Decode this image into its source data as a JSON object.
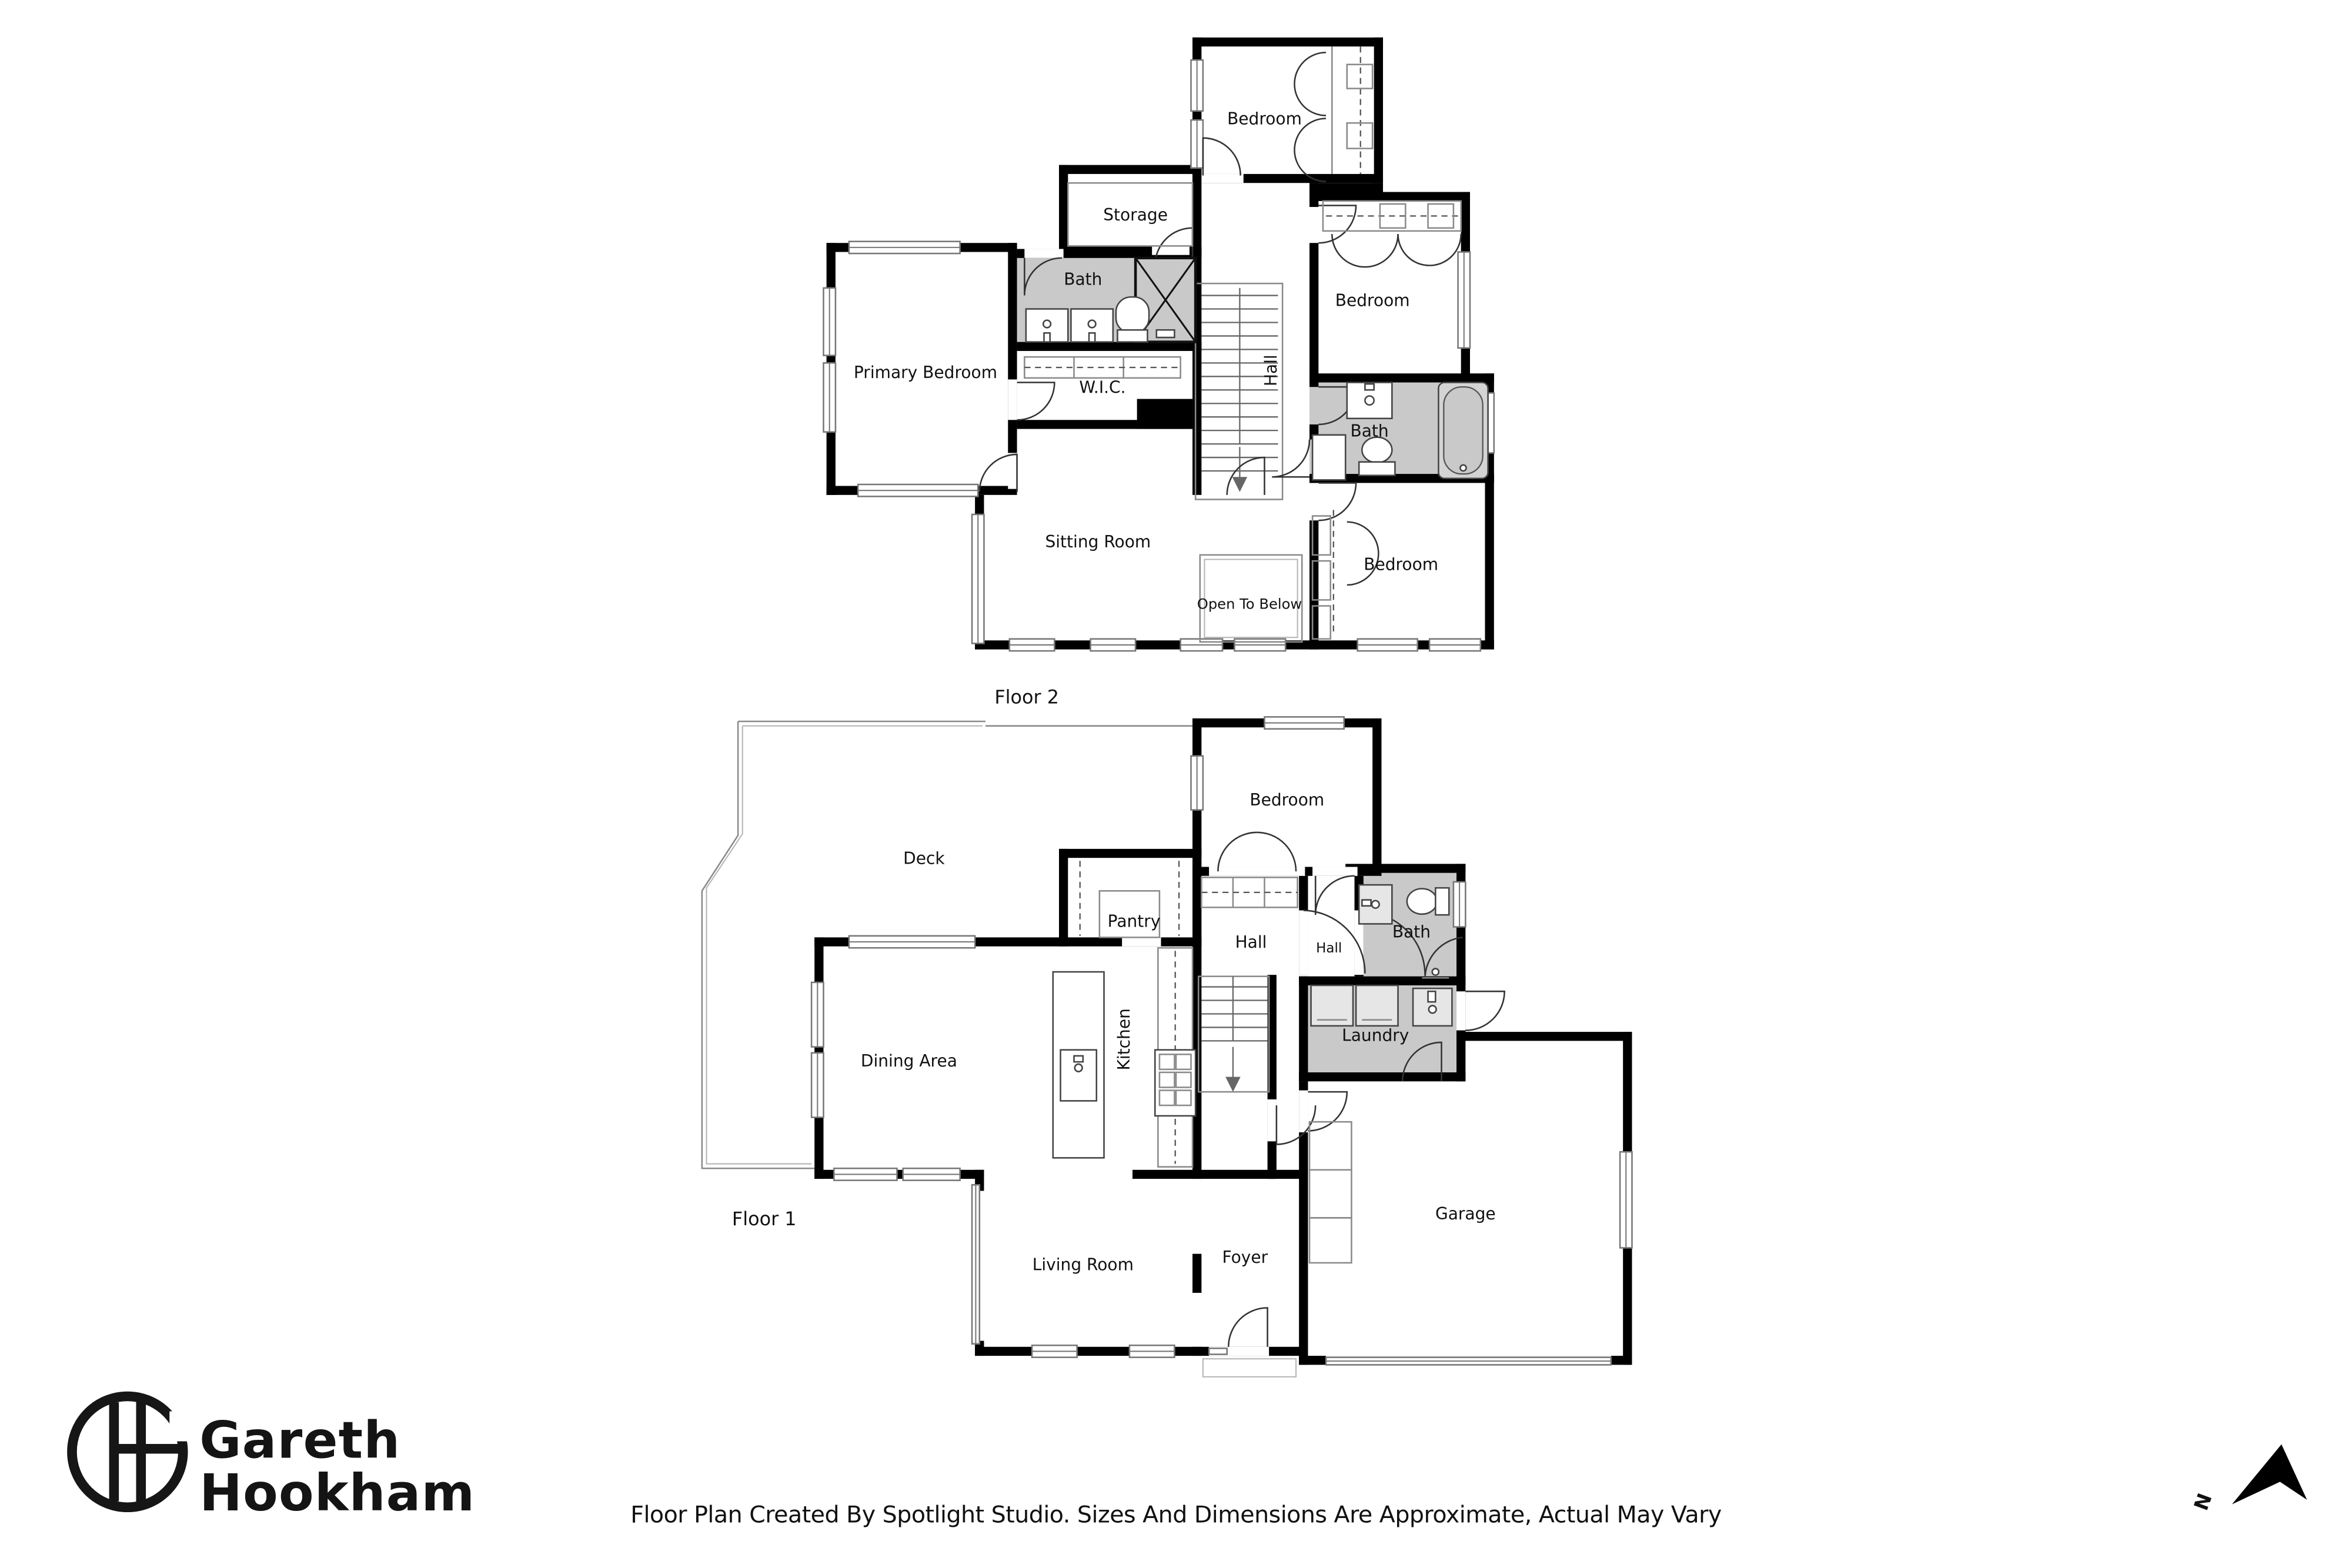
{
  "floor2": {
    "label": "Floor 2",
    "rooms": {
      "bedroom_top": "Bedroom",
      "storage": "Storage",
      "bath_upper": "Bath",
      "primary_bedroom": "Primary Bedroom",
      "wic": "W.I.C.",
      "hall": "Hall",
      "bedroom_right": "Bedroom",
      "bath_right": "Bath",
      "sitting_room": "Sitting Room",
      "open_to_below": "Open To Below",
      "bedroom_lower": "Bedroom"
    }
  },
  "floor1": {
    "label": "Floor 1",
    "rooms": {
      "deck": "Deck",
      "bedroom": "Bedroom",
      "pantry": "Pantry",
      "hall": "Hall",
      "hall_small": "Hall",
      "bath": "Bath",
      "dining_area": "Dining Area",
      "kitchen": "Kitchen",
      "laundry": "Laundry",
      "garage": "Garage",
      "living_room": "Living Room",
      "foyer": "Foyer"
    }
  },
  "branding": {
    "name_line1": "Gareth",
    "name_line2": "Hookham"
  },
  "compass": {
    "north_label": "N"
  },
  "footer": {
    "disclaimer": "Floor Plan Created By Spotlight Studio. Sizes And Dimensions Are Approximate, Actual May Vary"
  },
  "colors": {
    "wall": "#000000",
    "wet_room_fill": "#c9c9c9",
    "thin_line": "#8a8a8a",
    "text": "#111111",
    "background": "#ffffff"
  }
}
